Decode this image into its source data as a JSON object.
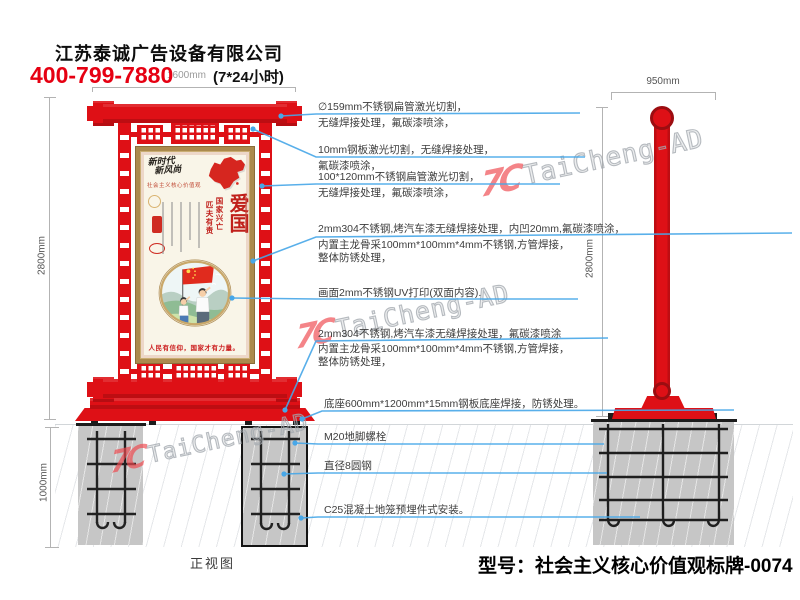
{
  "header": {
    "company": "江苏泰诚广告设备有限公司",
    "phone": "400-799-7880",
    "hours": "(7*24小时)"
  },
  "dimensions": {
    "top_width": "1600mm",
    "front_height": "2800mm",
    "foundation_depth": "1000mm",
    "side_width": "950mm",
    "side_height": "2800mm"
  },
  "annotations": [
    {
      "lines": [
        "∅159mm不锈钢扁管激光切割，",
        "无缝焊接处理，氟碳漆喷涂，"
      ]
    },
    {
      "lines": [
        "10mm钢板激光切割，无缝焊接处理，",
        "氟碳漆喷涂，"
      ]
    },
    {
      "lines": [
        "100*120mm不锈钢扁管激光切割，",
        "无缝焊接处理，氟碳漆喷涂，"
      ]
    },
    {
      "lines": [
        "2mm304不锈钢,烤汽车漆无缝焊接处理，内凹20mm,氟碳漆喷涂，",
        "内置主龙骨采100mm*100mm*4mm不锈钢,方管焊接，",
        "整体防锈处理，"
      ]
    },
    {
      "lines": [
        "画面2mm不锈钢UV打印(双面内容)."
      ]
    },
    {
      "lines": [
        "2mm304不锈钢,烤汽车漆无缝焊接处理，氟碳漆喷涂",
        "内置主龙骨采100mm*100mm*4mm不锈钢,方管焊接，",
        "整体防锈处理，"
      ]
    },
    {
      "lines": [
        "底座600mm*1200mm*15mm钢板底座焊接，防锈处理。"
      ]
    },
    {
      "lines": [
        "M20地脚螺栓"
      ]
    },
    {
      "lines": [
        "直径8圆钢"
      ]
    },
    {
      "lines": [
        "C25混凝土地笼预埋件式安装。"
      ]
    }
  ],
  "poster": {
    "calligraphy_line1": "新时代",
    "calligraphy_line2": "新风尚",
    "subtitle": "社会主义核心价值观",
    "motto_col_right": "国家兴亡",
    "motto_col_left": "匹夫有责",
    "theme": "爱国",
    "slogan": "人民有信仰，国家才有力量。"
  },
  "labels": {
    "front_view": "正视图",
    "model": "型号：社会主义核心价值观标牌-0074"
  },
  "watermark": {
    "logo": "7C",
    "text": "TaiCheng-AD"
  },
  "colors": {
    "sign_red": "#de1016",
    "callout_blue": "#47a7e8",
    "phone_red": "#e60012",
    "concrete_gray": "#c6c6c6",
    "gold_frame": "#ab8a4d",
    "poster_red": "#c01f1a"
  }
}
